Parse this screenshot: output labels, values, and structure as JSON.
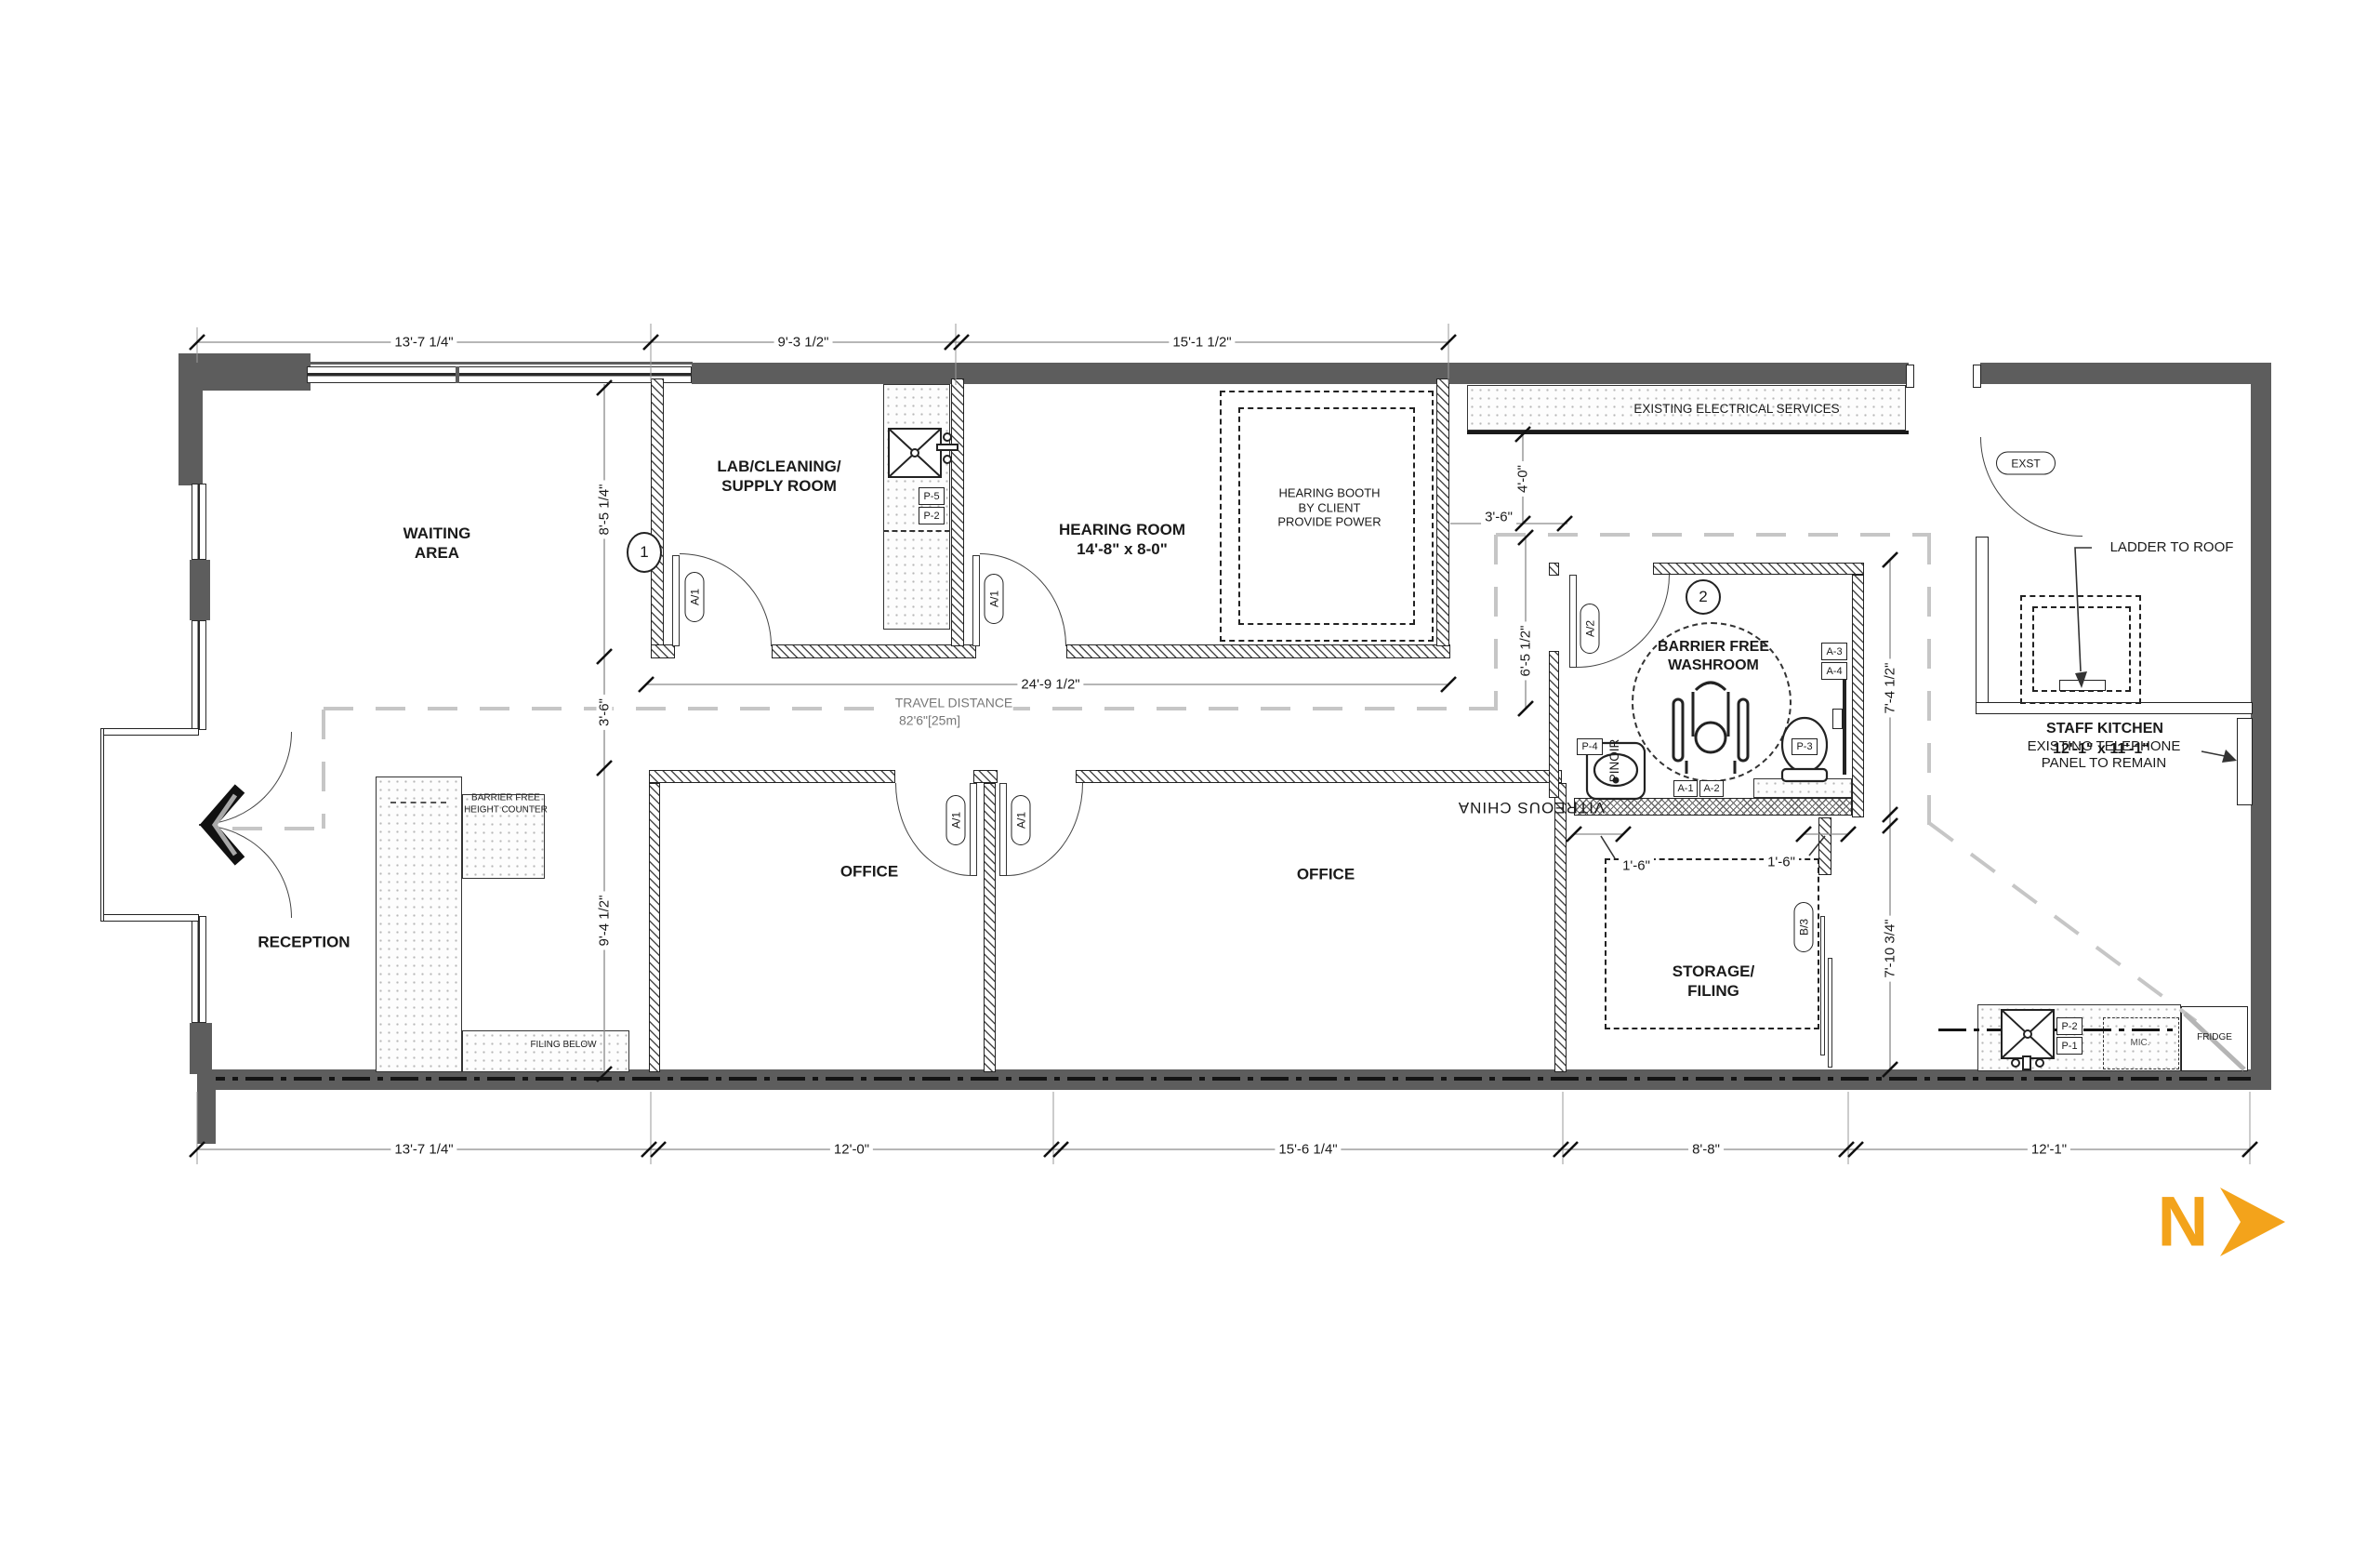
{
  "north_label": "N",
  "rooms": {
    "waiting": "WAITING\nAREA",
    "lab": "LAB/CLEANING/\nSUPPLY ROOM",
    "hearing": "HEARING ROOM\n14'-8\" x 8-0\"",
    "booth": "HEARING BOOTH\nBY CLIENT\nPROVIDE POWER",
    "electrical": "EXISTING ELECTRICAL SERVICES",
    "washroom": "BARRIER FREE\nWASHROOM",
    "reception": "RECEPTION",
    "office1": "OFFICE",
    "office2": "OFFICE",
    "storage": "STORAGE/\nFILING",
    "kitchen": "STAFF KITCHEN",
    "kitchen_size": "12'-1\" x 11'-1\""
  },
  "annotations": {
    "travel_1": "TRAVEL DISTANCE",
    "travel_2": "82'6\"[25m]",
    "ladder": "LADDER TO ROOF",
    "telephone": "EXISTING TELEPHONE\nPANEL TO REMAIN",
    "bf_counter": "BARRIER FREE\nHEIGHT COUNTER",
    "filing_below": "FILING BELOW",
    "vitreous": "VITREOUS CHINA",
    "pinoir": "PINOIR",
    "mic": "MIC.",
    "fridge": "FRIDGE"
  },
  "dimensions": {
    "top_1": "13'-7 1/4\"",
    "top_2": "9'-3 1/2\"",
    "top_3": "15'-1 1/2\"",
    "bot_1": "13'-7 1/4\"",
    "bot_2": "12'-0\"",
    "bot_3": "15'-6 1/4\"",
    "bot_4": "8'-8\"",
    "bot_5": "12'-1\"",
    "left_1": "8'-5 1/4\"",
    "left_2": "3'-6\"",
    "left_3": "9'-4 1/2\"",
    "mid": "24'-9 1/2\"",
    "w40": "4'-0\"",
    "w36": "3'-6\"",
    "w65": "6'-5 1/2\"",
    "w74": "7'-4 1/2\"",
    "w710": "7'-10 3/4\"",
    "s16a": "1'-6\"",
    "s16b": "1'-6\""
  },
  "tags": {
    "c1": "1",
    "c2": "2",
    "exst": "EXST",
    "a1": "A/1",
    "a2": "A/2",
    "b3": "B/3",
    "p5": "P-5",
    "p2": "P-2",
    "p4": "P-4",
    "p3": "P-3",
    "kp2": "P-2",
    "kp1": "P-1",
    "a3": "A-3",
    "a4": "A-4",
    "am1": "A-1",
    "am2": "A-2"
  },
  "colors": {
    "wall": "#5d5d5d",
    "north": "#F3A31B",
    "travel_path": "#c6c6c6"
  }
}
